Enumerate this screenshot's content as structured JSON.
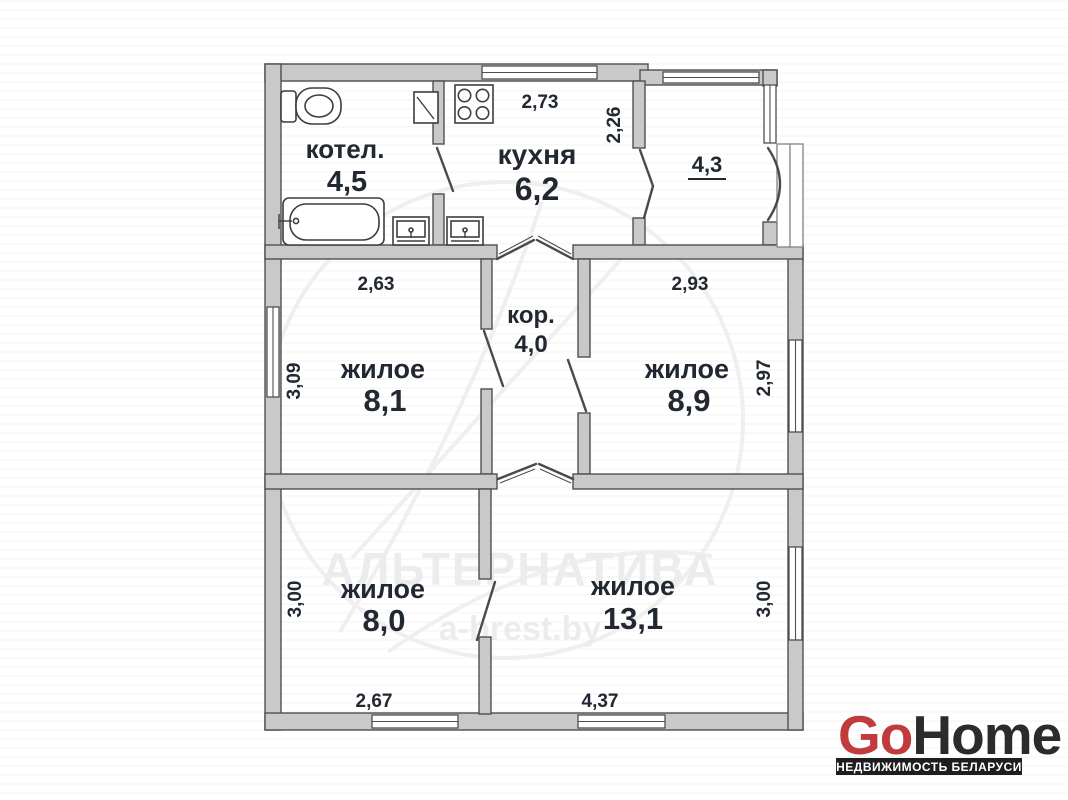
{
  "plan": {
    "rooms": {
      "boiler": {
        "label": "котел.",
        "area": "4,5"
      },
      "kitchen": {
        "label": "кухня",
        "area": "6,2"
      },
      "vestibule": {
        "area": "4,3"
      },
      "living_top_left": {
        "label": "жилое",
        "area": "8,1"
      },
      "corridor": {
        "label": "кор.",
        "area": "4,0"
      },
      "living_top_right": {
        "label": "жилое",
        "area": "8,9"
      },
      "living_bottom_left": {
        "label": "жилое",
        "area": "8,0"
      },
      "living_bottom_right": {
        "label": "жилое",
        "area": "13,1"
      }
    },
    "dimensions": {
      "kitchen_width": "2,73",
      "kitchen_depth": "2,26",
      "living_top_left_width": "2,63",
      "living_top_left_depth": "3,09",
      "living_top_right_width": "2,93",
      "living_top_right_depth": "2,97",
      "living_bottom_left_depth": "3,00",
      "living_bottom_left_width": "2,67",
      "living_bottom_right_width": "4,37",
      "living_bottom_right_depth": "3,00"
    },
    "fixtures": [
      "toilet-icon",
      "bathtub-icon",
      "sink-icon",
      "stove-icon",
      "water-heater-icon"
    ]
  },
  "watermark": {
    "agency": "АЛЬТЕРНАТИВА",
    "site": "a-brest.by"
  },
  "logo": {
    "go": "Go",
    "home": "Home",
    "tagline": "НЕДВИЖИМОСТЬ БЕЛАРУСИ"
  },
  "colors": {
    "wall_fill": "#c9c9c9",
    "wall_stroke": "#4f4f4f",
    "label_text": "#222831",
    "logo_red": "#c13a3c",
    "logo_dark": "#2b2b2b",
    "tagline_bg": "#1e1e1e",
    "watermark_gray": "#ececec"
  }
}
